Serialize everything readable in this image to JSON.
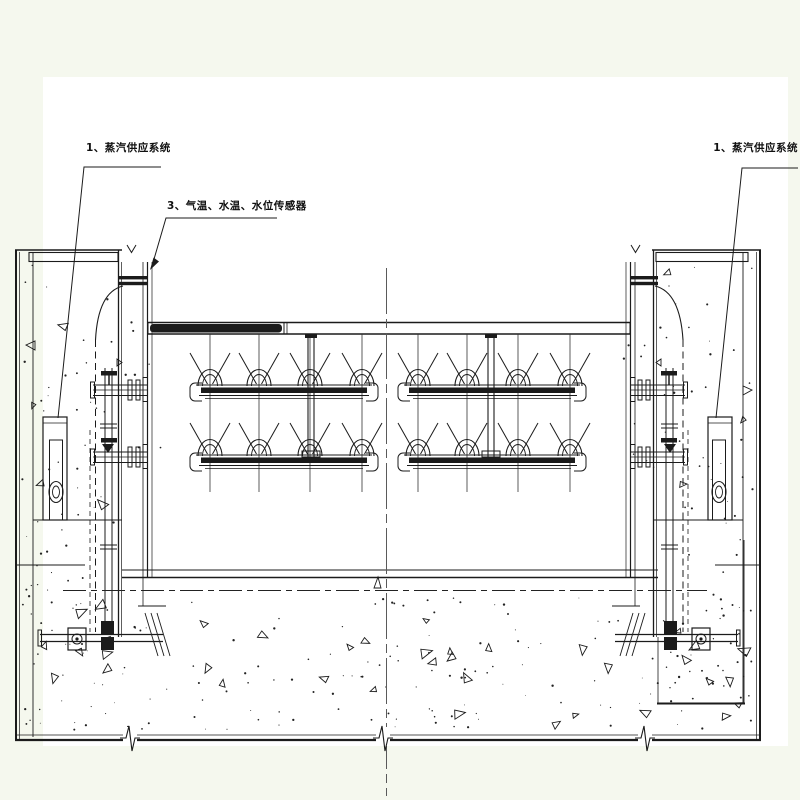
{
  "labels": {
    "steam_supply_left": "1、蒸汽供应系统",
    "sensors": "3、气温、水温、水位传感器",
    "steam_supply_right": "1、蒸汽供应系统"
  },
  "colors": {
    "paper": "#ffffff",
    "margin": "#f5f8ee",
    "line": "#1b1b1b",
    "centerline": "#5a5a5a"
  }
}
